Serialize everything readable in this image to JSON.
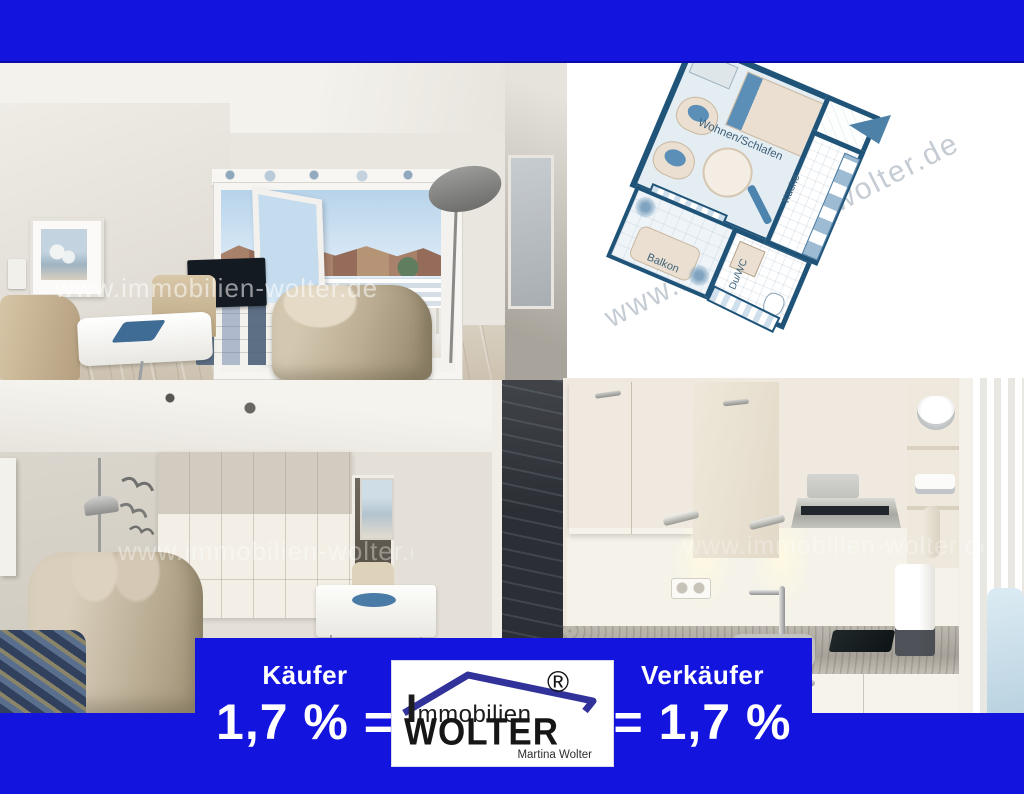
{
  "colors": {
    "banner_blue": "#1414DF",
    "plan_wall_navy": "#1F5378",
    "plan_accent_blue": "#5B8FB7",
    "logo_roof_indigo": "#32329B"
  },
  "watermark": {
    "text": "www.immobilien-wolter.de"
  },
  "floor_plan": {
    "labels": {
      "living": "Wohnen/Schlafen",
      "kitchen": "Küche",
      "bath": "Du/WC",
      "balcony": "Balkon"
    }
  },
  "banner": {
    "buyer_label": "Käufer",
    "buyer_rate": "1,7 % =",
    "seller_label": "Verkäufer",
    "seller_rate": "= 1,7 %"
  },
  "logo": {
    "brand_top": "Immobilien",
    "brand_main": "WOLTER",
    "owner": "Martina Wolter",
    "registered_mark": "®"
  }
}
